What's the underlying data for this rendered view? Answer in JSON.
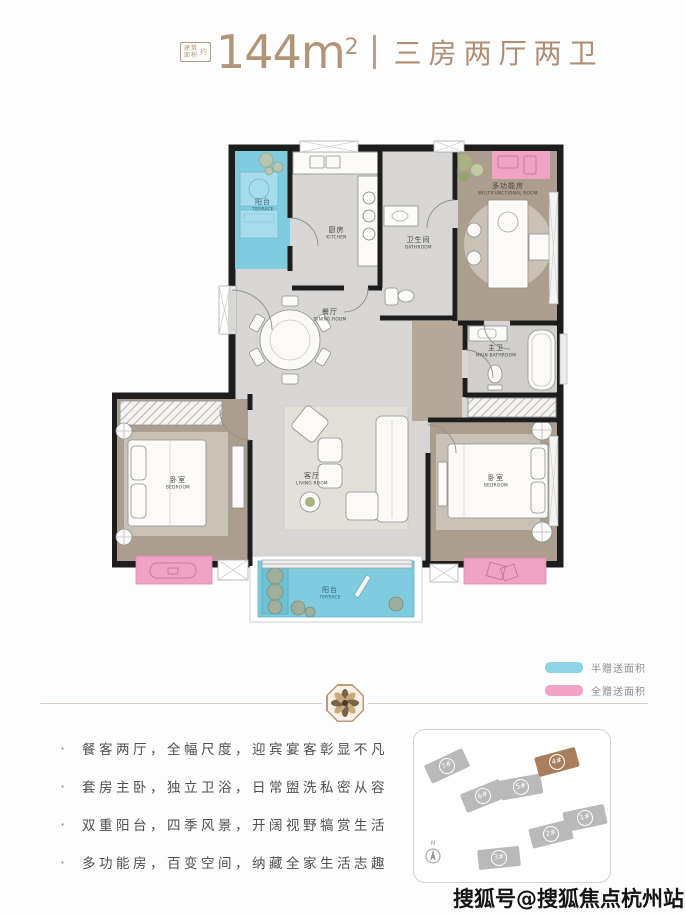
{
  "header": {
    "area_note": {
      "line1": "建筑",
      "line2": "面积",
      "suffix": "约"
    },
    "area_value": "144m",
    "area_unit_sup": "2",
    "layout_title": "三房两厅两卫",
    "accent_color": "#b29479"
  },
  "floorplan": {
    "rooms": [
      {
        "cn": "阳台",
        "en": "TERRACE"
      },
      {
        "cn": "厨房",
        "en": "KITCHEN"
      },
      {
        "cn": "卫生间",
        "en": "BATHROOM"
      },
      {
        "cn": "多功能房",
        "en": "MULTIFUNCTIONAL ROOM"
      },
      {
        "cn": "餐厅",
        "en": "DINING ROOM"
      },
      {
        "cn": "主卫",
        "en": "MAIN BATHROOM"
      },
      {
        "cn": "卧室",
        "en": "BEDROOM"
      },
      {
        "cn": "客厅",
        "en": "LIVING ROOM"
      },
      {
        "cn": "卧室",
        "en": "BEDROOM"
      },
      {
        "cn": "阳台",
        "en": "TERRACE"
      }
    ],
    "colors": {
      "wall": "#1d1d1d",
      "tile_floor": "#d7d6d4",
      "wood_floor": "#aca092",
      "half_gift_blue": "#7fccdf",
      "full_gift_pink": "#f0a2c3"
    }
  },
  "legend": {
    "items": [
      {
        "label": "半赠送面积",
        "color": "#8ed2e6"
      },
      {
        "label": "全赠送面积",
        "color": "#f2a2c4"
      }
    ]
  },
  "features": {
    "bullet": "·",
    "items": [
      "餐客两厅，全幅尺度，迎宾宴客彰显不凡",
      "套房主卧，独立卫浴，日常盥洗私密从容",
      "双重阳台，四季风景，开阔视野犒赏生活",
      "多功能房，百变空间，纳藏全家生活志趣"
    ]
  },
  "siteplan": {
    "north_label": "N",
    "buildings": [
      {
        "label": "7#",
        "highlight": false
      },
      {
        "label": "6#",
        "highlight": false
      },
      {
        "label": "5#",
        "highlight": false
      },
      {
        "label": "4#",
        "highlight": true
      },
      {
        "label": "1#",
        "highlight": false
      },
      {
        "label": "2#",
        "highlight": false
      },
      {
        "label": "3#",
        "highlight": false
      }
    ]
  },
  "watermark": "搜狐号@搜狐焦点杭州站"
}
